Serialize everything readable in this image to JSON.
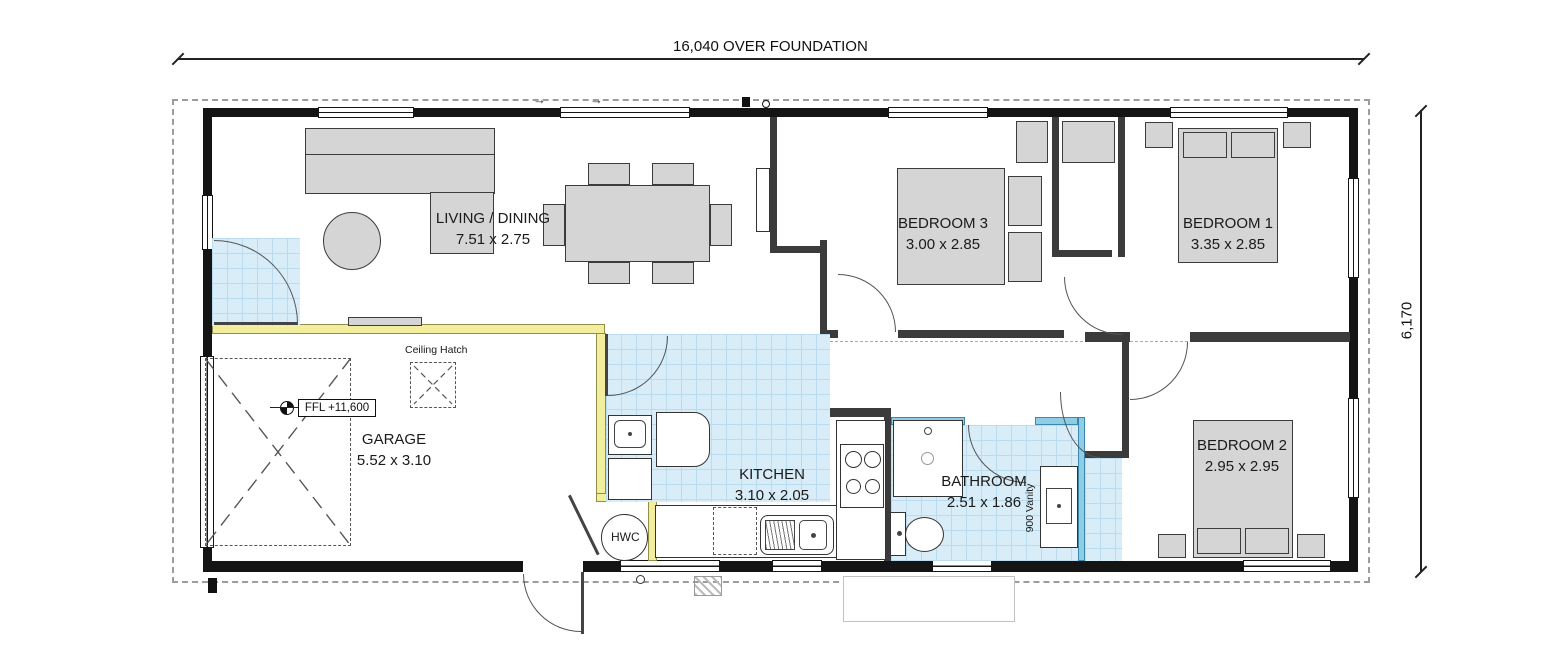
{
  "dims": {
    "top_label": "16,040 OVER FOUNDATION",
    "right_label": "6,170"
  },
  "rooms": {
    "living": {
      "name": "LIVING / DINING",
      "size": "7.51 x 2.75"
    },
    "garage": {
      "name": "GARAGE",
      "size": "5.52 x 3.10"
    },
    "kitchen": {
      "name": "KITCHEN",
      "size": "3.10 x 2.05"
    },
    "bathroom": {
      "name": "BATHROOM",
      "size": "2.51 x 1.86"
    },
    "bedroom1": {
      "name": "BEDROOM 1",
      "size": "3.35 x 2.85"
    },
    "bedroom2": {
      "name": "BEDROOM 2",
      "size": "2.95 x 2.95"
    },
    "bedroom3": {
      "name": "BEDROOM 3",
      "size": "3.00 x 2.85"
    }
  },
  "annotations": {
    "ceiling_hatch": "Ceiling Hatch",
    "ffl": "FFL +11,600",
    "hwc": "HWC",
    "vanity": "900 Vanity"
  },
  "icons": {
    "slider_arrow": "→"
  },
  "colors": {
    "wall": "#141414",
    "interior_wall": "#3b3b3b",
    "fire_wall_yellow": "#f2ee9e",
    "wet_wall_cyan": "#8fcce6",
    "tile_blue": "#d9edf8",
    "furniture_grey": "#d5d5d5",
    "foundation_dash": "#9c9c9c"
  }
}
